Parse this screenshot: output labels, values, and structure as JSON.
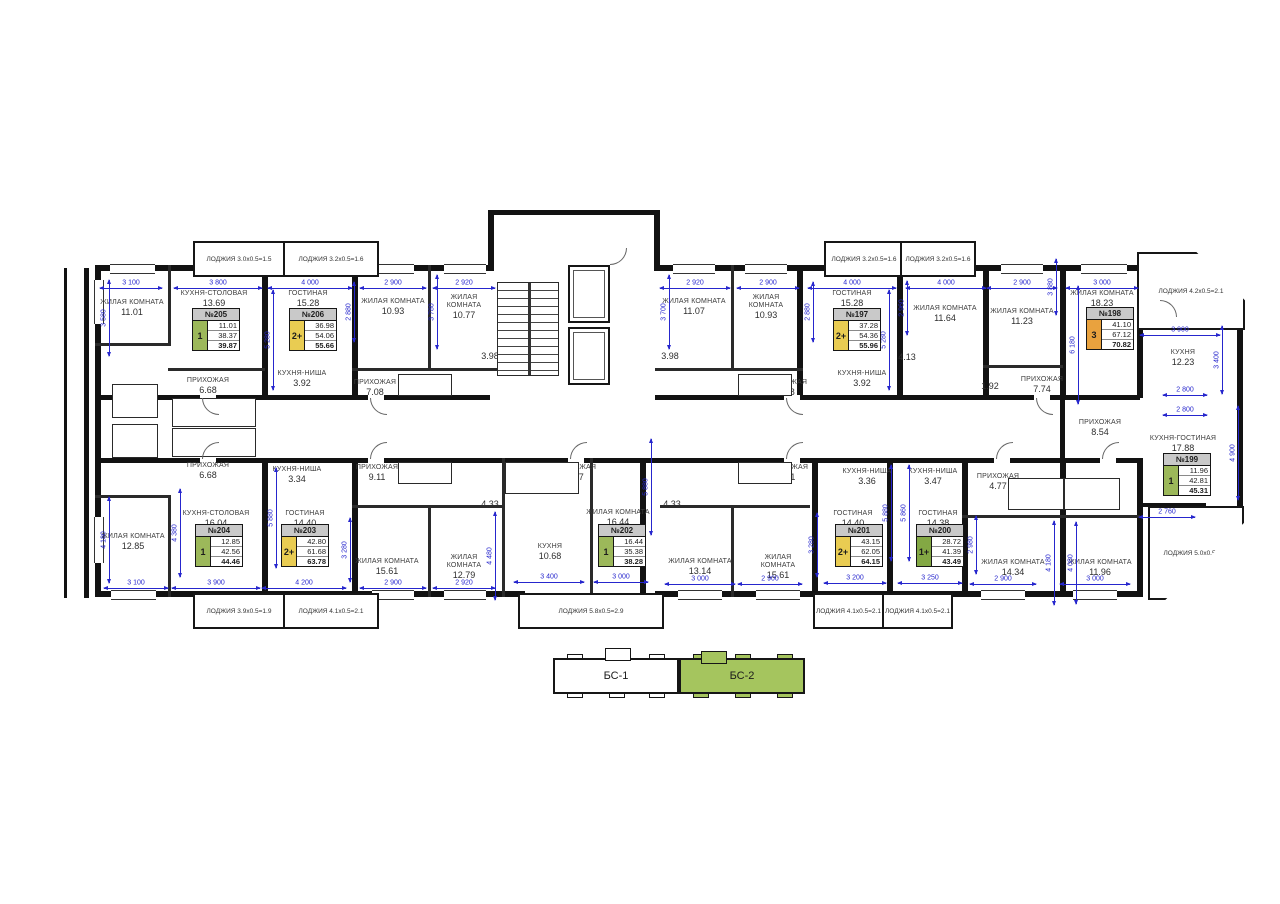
{
  "colors": {
    "badge_green": "#9cb85a",
    "badge_green_dark": "#83a844",
    "badge_yellow": "#e9cc52",
    "badge_orange": "#e9a23e",
    "keyplan_active": "#a5c55e",
    "dim_blue": "#2626cd",
    "card_header_gray": "#c9c9c9"
  },
  "apartments": [
    {
      "num": "№205",
      "badge": "1",
      "badge_color": "badge_green",
      "values": [
        "11.01",
        "38.37",
        "39.87"
      ],
      "x": 192,
      "y": 308
    },
    {
      "num": "№206",
      "badge": "2+",
      "badge_color": "badge_yellow",
      "values": [
        "36.98",
        "54.06",
        "55.66"
      ],
      "x": 289,
      "y": 308
    },
    {
      "num": "№197",
      "badge": "2+",
      "badge_color": "badge_yellow",
      "values": [
        "37.28",
        "54.36",
        "55.96"
      ],
      "x": 833,
      "y": 308
    },
    {
      "num": "№198",
      "badge": "3",
      "badge_color": "badge_orange",
      "values": [
        "41.10",
        "67.12",
        "70.82"
      ],
      "x": 1086,
      "y": 307
    },
    {
      "num": "№204",
      "badge": "1",
      "badge_color": "badge_green",
      "values": [
        "12.85",
        "42.56",
        "44.46"
      ],
      "x": 195,
      "y": 524
    },
    {
      "num": "№203",
      "badge": "2+",
      "badge_color": "badge_yellow",
      "values": [
        "42.80",
        "61.68",
        "63.78"
      ],
      "x": 281,
      "y": 524
    },
    {
      "num": "№202",
      "badge": "1",
      "badge_color": "badge_green",
      "values": [
        "16.44",
        "35.38",
        "38.28"
      ],
      "x": 598,
      "y": 524
    },
    {
      "num": "№201",
      "badge": "2+",
      "badge_color": "badge_yellow",
      "values": [
        "43.15",
        "62.05",
        "64.15"
      ],
      "x": 835,
      "y": 524
    },
    {
      "num": "№200",
      "badge": "1+",
      "badge_color": "badge_green_dark",
      "values": [
        "28.72",
        "41.39",
        "43.49"
      ],
      "x": 916,
      "y": 524
    },
    {
      "num": "№199",
      "badge": "1",
      "badge_color": "badge_green",
      "values": [
        "11.96",
        "42.81",
        "45.31"
      ],
      "x": 1163,
      "y": 453
    }
  ],
  "rooms": [
    {
      "name": "ЖИЛАЯ КОМНАТА",
      "area": "11.01",
      "x": 132,
      "y": 308,
      "w": 70
    },
    {
      "name": "КУХНЯ-СТОЛОВАЯ",
      "area": "13.69",
      "x": 214,
      "y": 299,
      "w": 84
    },
    {
      "name": "ГОСТИНАЯ",
      "area": "15.28",
      "x": 308,
      "y": 299,
      "w": 70
    },
    {
      "name": "ЖИЛАЯ КОМНАТА",
      "area": "10.93",
      "x": 393,
      "y": 307,
      "w": 66
    },
    {
      "name": "ЖИЛАЯ КОМНАТА",
      "area": "10.77",
      "x": 464,
      "y": 307,
      "w": 62
    },
    {
      "name": "ЖИЛАЯ КОМНАТА",
      "area": "11.07",
      "x": 694,
      "y": 307,
      "w": 66
    },
    {
      "name": "ЖИЛАЯ КОМНАТА",
      "area": "10.93",
      "x": 766,
      "y": 307,
      "w": 62
    },
    {
      "name": "ГОСТИНАЯ",
      "area": "15.28",
      "x": 852,
      "y": 299,
      "w": 70
    },
    {
      "name": "ЖИЛАЯ КОМНАТА",
      "area": "11.64",
      "x": 945,
      "y": 314,
      "w": 72
    },
    {
      "name": "ЖИЛАЯ КОМНАТА",
      "area": "11.23",
      "x": 1022,
      "y": 317,
      "w": 66
    },
    {
      "name": "ЖИЛАЯ КОМНАТА",
      "area": "18.23",
      "x": 1102,
      "y": 299,
      "w": 76
    },
    {
      "name": "КУХНЯ",
      "area": "12.23",
      "x": 1183,
      "y": 358,
      "w": 60
    },
    {
      "name": "КУХНЯ-НИША",
      "area": "3.92",
      "x": 302,
      "y": 379,
      "w": 62
    },
    {
      "name": "КУХНЯ-НИША",
      "area": "3.92",
      "x": 862,
      "y": 379,
      "w": 62
    },
    {
      "name": "ПРИХОЖАЯ",
      "area": "6.68",
      "x": 208,
      "y": 386,
      "w": 62
    },
    {
      "name": "ПРИХОЖАЯ",
      "area": "7.08",
      "x": 375,
      "y": 388,
      "w": 58
    },
    {
      "name": "ПРИХОЖАЯ",
      "area": "7.08",
      "x": 786,
      "y": 388,
      "w": 58
    },
    {
      "name": "ПРИХОЖАЯ",
      "area": "7.74",
      "x": 1042,
      "y": 385,
      "w": 60
    },
    {
      "name": "ГАРДЕРОБНАЯ",
      "area": "2.31",
      "x": 213,
      "y": 411,
      "w": 78
    },
    {
      "name": "ГАРДЕРОБНАЯ",
      "area": "2.31",
      "x": 213,
      "y": 441,
      "w": 78
    },
    {
      "name": "",
      "area": "4.68",
      "x": 140,
      "y": 404,
      "w": 30
    },
    {
      "name": "",
      "area": "4.68",
      "x": 140,
      "y": 448,
      "w": 30
    },
    {
      "name": "",
      "area": "2.10",
      "x": 413,
      "y": 384,
      "w": 30
    },
    {
      "name": "",
      "area": "2.10",
      "x": 748,
      "y": 384,
      "w": 30
    },
    {
      "name": "",
      "area": "3.98",
      "x": 490,
      "y": 356,
      "w": 30
    },
    {
      "name": "",
      "area": "3.98",
      "x": 670,
      "y": 356,
      "w": 30
    },
    {
      "name": "",
      "area": "4.13",
      "x": 907,
      "y": 357,
      "w": 30
    },
    {
      "name": "",
      "area": "1.92",
      "x": 990,
      "y": 386,
      "w": 30
    },
    {
      "name": "ПРИХОЖАЯ",
      "area": "8.54",
      "x": 1100,
      "y": 428,
      "w": 60
    },
    {
      "name": "КУХНЯ-ГОСТИНАЯ",
      "area": "17.88",
      "x": 1183,
      "y": 444,
      "w": 84
    },
    {
      "name": "ЖИЛАЯ КОМНАТА",
      "area": "12.85",
      "x": 133,
      "y": 542,
      "w": 70
    },
    {
      "name": "КУХНЯ-СТОЛОВАЯ",
      "area": "16.04",
      "x": 216,
      "y": 519,
      "w": 84
    },
    {
      "name": "ГОСТИНАЯ",
      "area": "14.40",
      "x": 305,
      "y": 519,
      "w": 70
    },
    {
      "name": "КУХНЯ-НИША",
      "area": "3.34",
      "x": 297,
      "y": 475,
      "w": 62
    },
    {
      "name": "ПРИХОЖАЯ",
      "area": "6.68",
      "x": 208,
      "y": 471,
      "w": 62
    },
    {
      "name": "ПРИХОЖАЯ",
      "area": "9.11",
      "x": 377,
      "y": 473,
      "w": 58
    },
    {
      "name": "",
      "area": "2.10",
      "x": 413,
      "y": 471,
      "w": 30
    },
    {
      "name": "",
      "area": "4.33",
      "x": 490,
      "y": 504,
      "w": 30
    },
    {
      "name": "",
      "area": "4.09",
      "x": 532,
      "y": 479,
      "w": 30
    },
    {
      "name": "ПРИХОЖАЯ",
      "area": "4.17",
      "x": 575,
      "y": 473,
      "w": 58
    },
    {
      "name": "ЖИЛАЯ КОМНАТА",
      "area": "15.61",
      "x": 387,
      "y": 567,
      "w": 66
    },
    {
      "name": "ЖИЛАЯ КОМНАТА",
      "area": "12.79",
      "x": 464,
      "y": 567,
      "w": 62
    },
    {
      "name": "КУХНЯ",
      "area": "10.68",
      "x": 550,
      "y": 552,
      "w": 50
    },
    {
      "name": "ЖИЛАЯ КОМНАТА",
      "area": "16.44",
      "x": 618,
      "y": 518,
      "w": 64
    },
    {
      "name": "",
      "area": "2.10",
      "x": 748,
      "y": 471,
      "w": 30
    },
    {
      "name": "",
      "area": "4.33",
      "x": 672,
      "y": 504,
      "w": 30
    },
    {
      "name": "ПРИХОЖАЯ",
      "area": "9.11",
      "x": 787,
      "y": 473,
      "w": 58
    },
    {
      "name": "КУХНЯ-НИША",
      "area": "3.36",
      "x": 867,
      "y": 477,
      "w": 62
    },
    {
      "name": "КУХНЯ-НИША",
      "area": "3.47",
      "x": 933,
      "y": 477,
      "w": 62
    },
    {
      "name": "ГОСТИНАЯ",
      "area": "14.40",
      "x": 853,
      "y": 519,
      "w": 66
    },
    {
      "name": "ГОСТИНАЯ",
      "area": "14.38",
      "x": 938,
      "y": 519,
      "w": 66
    },
    {
      "name": "ЖИЛАЯ КОМНАТА",
      "area": "13.14",
      "x": 700,
      "y": 567,
      "w": 66
    },
    {
      "name": "ЖИЛАЯ КОМНАТА",
      "area": "15.61",
      "x": 778,
      "y": 567,
      "w": 62
    },
    {
      "name": "ПРИХОЖАЯ",
      "area": "4.77",
      "x": 998,
      "y": 482,
      "w": 58
    },
    {
      "name": "",
      "area": "4.43",
      "x": 1033,
      "y": 492,
      "w": 30
    },
    {
      "name": "",
      "area": "4.43",
      "x": 1093,
      "y": 492,
      "w": 30
    },
    {
      "name": "ЖИЛАЯ КОМНАТА",
      "area": "14.34",
      "x": 1013,
      "y": 568,
      "w": 66
    },
    {
      "name": "ЖИЛАЯ КОМНАТА",
      "area": "11.96",
      "x": 1100,
      "y": 568,
      "w": 66
    }
  ],
  "loggias": [
    {
      "label": "ЛОДЖИЯ 3.0x0.5=1.5",
      "x": 193,
      "y": 241,
      "w": 88,
      "h": 32,
      "bay": false
    },
    {
      "label": "ЛОДЖИЯ 3.2x0.5=1.6",
      "x": 283,
      "y": 241,
      "w": 92,
      "h": 32,
      "bay": false
    },
    {
      "label": "ЛОДЖИЯ 3.2x0.5=1.6",
      "x": 824,
      "y": 241,
      "w": 76,
      "h": 32,
      "bay": false
    },
    {
      "label": "ЛОДЖИЯ 3.2x0.5=1.6",
      "x": 900,
      "y": 241,
      "w": 72,
      "h": 32,
      "bay": false
    },
    {
      "label": "ЛОДЖИЯ 4.2x0.5=2.1",
      "x": 1137,
      "y": 252,
      "w": 104,
      "h": 74,
      "bay": true,
      "clip": "polygon(0 0,55% 0,100% 62%,100% 100%,0 100%)"
    },
    {
      "label": "ЛОДЖИЯ 3.9x0.5=1.9",
      "x": 193,
      "y": 593,
      "w": 88,
      "h": 32,
      "bay": false
    },
    {
      "label": "ЛОДЖИЯ 4.1x0.5=2.1",
      "x": 283,
      "y": 593,
      "w": 92,
      "h": 32,
      "bay": false
    },
    {
      "label": "ЛОДЖИЯ 5.8x0.5=2.9",
      "x": 518,
      "y": 593,
      "w": 142,
      "h": 32,
      "bay": false
    },
    {
      "label": "ЛОДЖИЯ 4.1x0.5=2.1",
      "x": 813,
      "y": 593,
      "w": 67,
      "h": 32,
      "bay": false
    },
    {
      "label": "ЛОДЖИЯ 4.1x0.5=2.1",
      "x": 882,
      "y": 593,
      "w": 67,
      "h": 32,
      "bay": false
    },
    {
      "label": "ЛОДЖИЯ 5.0x0.5=2.5",
      "x": 1148,
      "y": 506,
      "w": 92,
      "h": 90,
      "bay": true,
      "clip": "polygon(0 0,100% 0,100% 18%,18% 100%,0 100%)"
    }
  ],
  "dims": [
    {
      "t": "3 100",
      "x": 131,
      "y": 283,
      "len": 62,
      "v": false
    },
    {
      "t": "3 800",
      "x": 218,
      "y": 283,
      "len": 88,
      "v": false
    },
    {
      "t": "4 000",
      "x": 310,
      "y": 283,
      "len": 84,
      "v": false
    },
    {
      "t": "2 900",
      "x": 393,
      "y": 283,
      "len": 66,
      "v": false
    },
    {
      "t": "2 920",
      "x": 464,
      "y": 283,
      "len": 62,
      "v": false
    },
    {
      "t": "2 920",
      "x": 695,
      "y": 283,
      "len": 70,
      "v": false
    },
    {
      "t": "2 900",
      "x": 768,
      "y": 283,
      "len": 62,
      "v": false
    },
    {
      "t": "4 000",
      "x": 852,
      "y": 283,
      "len": 88,
      "v": false
    },
    {
      "t": "4 000",
      "x": 946,
      "y": 283,
      "len": 80,
      "v": false
    },
    {
      "t": "2 900",
      "x": 1022,
      "y": 283,
      "len": 70,
      "v": false
    },
    {
      "t": "3 000",
      "x": 1102,
      "y": 283,
      "len": 72,
      "v": false
    },
    {
      "t": "3 900",
      "x": 1180,
      "y": 330,
      "len": 80,
      "v": false
    },
    {
      "t": "2 800",
      "x": 1185,
      "y": 390,
      "len": 44,
      "v": false
    },
    {
      "t": "2 800",
      "x": 1185,
      "y": 410,
      "len": 44,
      "v": false
    },
    {
      "t": "3 100",
      "x": 136,
      "y": 583,
      "len": 64,
      "v": false
    },
    {
      "t": "3 900",
      "x": 216,
      "y": 583,
      "len": 88,
      "v": false
    },
    {
      "t": "4 200",
      "x": 304,
      "y": 583,
      "len": 84,
      "v": false
    },
    {
      "t": "2 900",
      "x": 393,
      "y": 583,
      "len": 66,
      "v": false
    },
    {
      "t": "2 920",
      "x": 464,
      "y": 583,
      "len": 62,
      "v": false
    },
    {
      "t": "3 400",
      "x": 549,
      "y": 577,
      "len": 70,
      "v": false
    },
    {
      "t": "3 000",
      "x": 621,
      "y": 577,
      "len": 54,
      "v": false
    },
    {
      "t": "3 000",
      "x": 700,
      "y": 579,
      "len": 70,
      "v": false
    },
    {
      "t": "2 900",
      "x": 770,
      "y": 579,
      "len": 64,
      "v": false
    },
    {
      "t": "3 200",
      "x": 855,
      "y": 578,
      "len": 62,
      "v": false
    },
    {
      "t": "3 250",
      "x": 930,
      "y": 578,
      "len": 64,
      "v": false
    },
    {
      "t": "2 900",
      "x": 1003,
      "y": 579,
      "len": 66,
      "v": false
    },
    {
      "t": "3 000",
      "x": 1095,
      "y": 579,
      "len": 70,
      "v": false
    },
    {
      "t": "2 760",
      "x": 1167,
      "y": 512,
      "len": 56,
      "v": false
    },
    {
      "t": "3 580",
      "x": 104,
      "y": 318,
      "len": 76,
      "v": true
    },
    {
      "t": "4 180",
      "x": 104,
      "y": 540,
      "len": 86,
      "v": true
    },
    {
      "t": "2 880",
      "x": 349,
      "y": 312,
      "len": 60,
      "v": true
    },
    {
      "t": "5 280",
      "x": 268,
      "y": 340,
      "len": 100,
      "v": true
    },
    {
      "t": "3 780",
      "x": 432,
      "y": 312,
      "len": 74,
      "v": true
    },
    {
      "t": "3 700",
      "x": 664,
      "y": 312,
      "len": 74,
      "v": true
    },
    {
      "t": "2 880",
      "x": 808,
      "y": 312,
      "len": 60,
      "v": true
    },
    {
      "t": "5 280",
      "x": 884,
      "y": 340,
      "len": 100,
      "v": true
    },
    {
      "t": "2 960",
      "x": 902,
      "y": 308,
      "len": 54,
      "v": true
    },
    {
      "t": "3 880",
      "x": 1051,
      "y": 287,
      "len": 56,
      "v": true
    },
    {
      "t": "6 180",
      "x": 1073,
      "y": 345,
      "len": 118,
      "v": true
    },
    {
      "t": "3 400",
      "x": 1217,
      "y": 360,
      "len": 68,
      "v": true
    },
    {
      "t": "4 900",
      "x": 1233,
      "y": 453,
      "len": 94,
      "v": true
    },
    {
      "t": "4 380",
      "x": 175,
      "y": 533,
      "len": 88,
      "v": true
    },
    {
      "t": "5 880",
      "x": 271,
      "y": 518,
      "len": 100,
      "v": true
    },
    {
      "t": "3 280",
      "x": 345,
      "y": 550,
      "len": 64,
      "v": true
    },
    {
      "t": "4 480",
      "x": 490,
      "y": 556,
      "len": 88,
      "v": true
    },
    {
      "t": "5 880",
      "x": 646,
      "y": 487,
      "len": 96,
      "v": true
    },
    {
      "t": "3 280",
      "x": 812,
      "y": 545,
      "len": 64,
      "v": true
    },
    {
      "t": "5 880",
      "x": 886,
      "y": 513,
      "len": 96,
      "v": true
    },
    {
      "t": "5 860",
      "x": 904,
      "y": 513,
      "len": 96,
      "v": true
    },
    {
      "t": "2 980",
      "x": 971,
      "y": 545,
      "len": 58,
      "v": true
    },
    {
      "t": "4 180",
      "x": 1049,
      "y": 563,
      "len": 84,
      "v": true
    },
    {
      "t": "4 080",
      "x": 1071,
      "y": 563,
      "len": 82,
      "v": true
    }
  ],
  "keyplan": {
    "sections": [
      {
        "label": "БС-1",
        "active": false
      },
      {
        "label": "БС-2",
        "active": true
      }
    ]
  }
}
